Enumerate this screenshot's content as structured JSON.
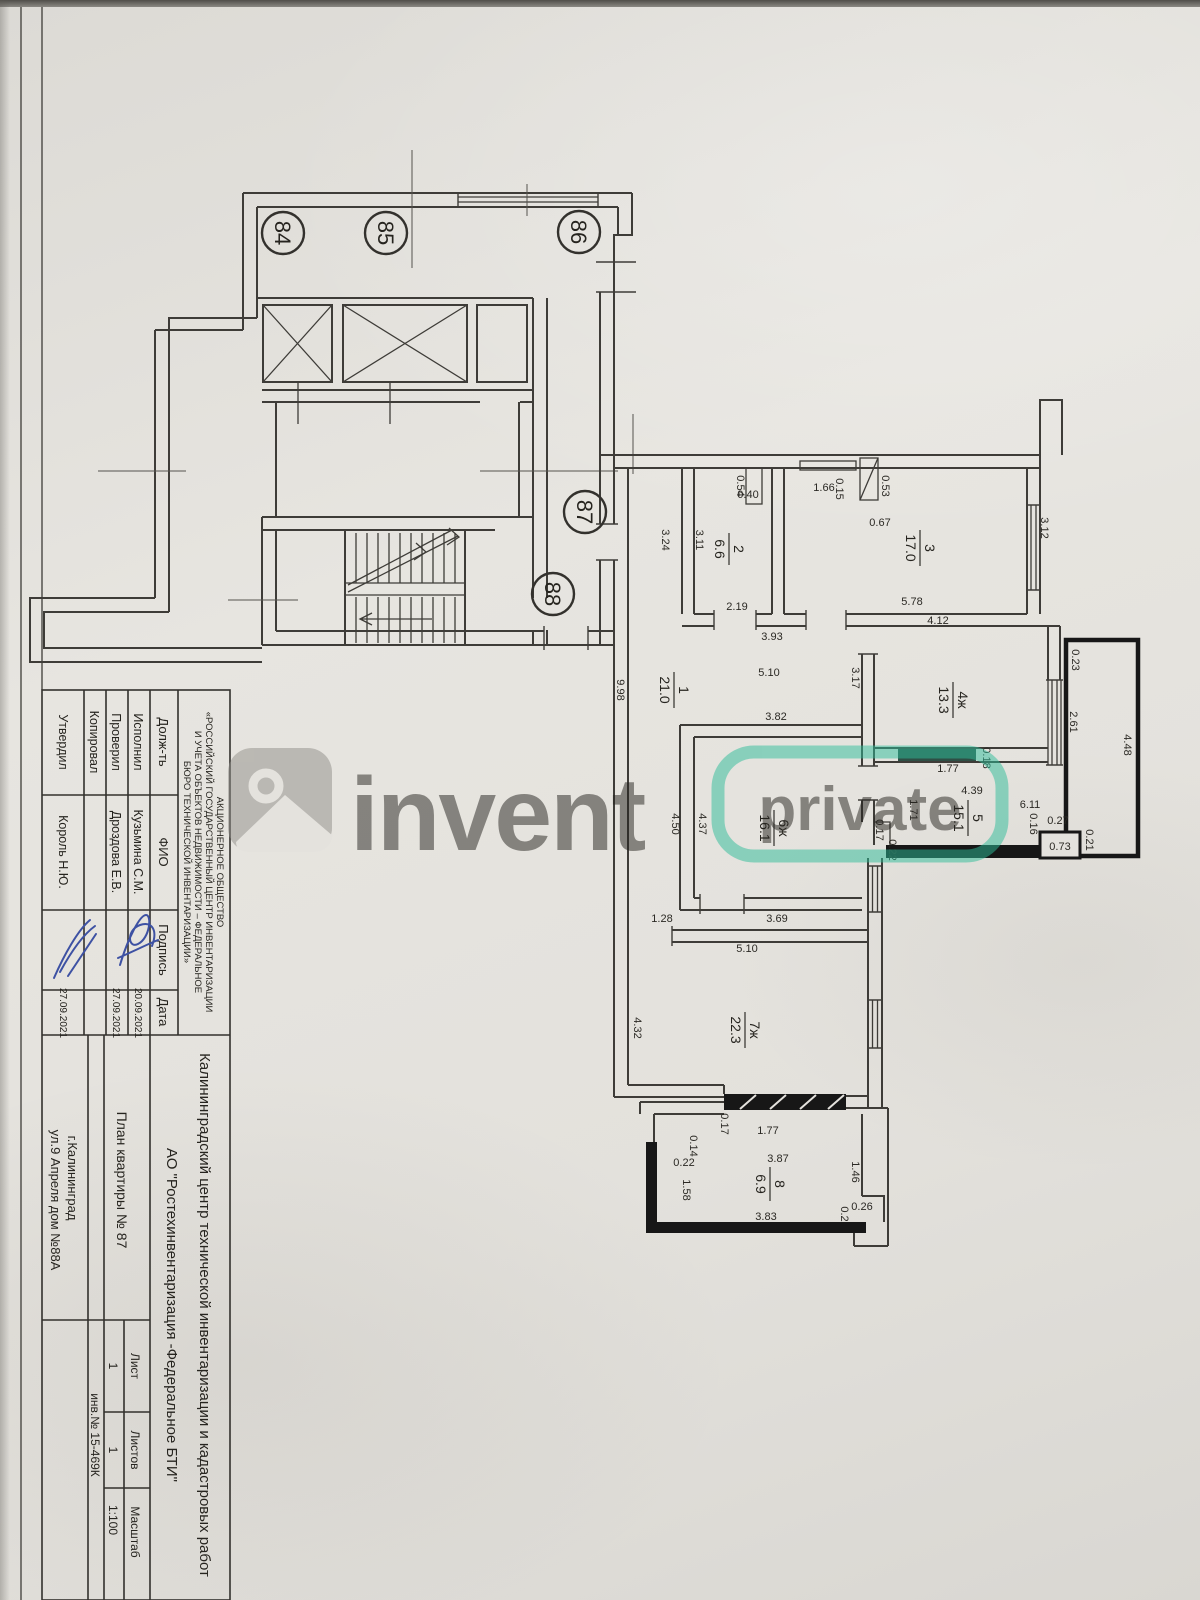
{
  "document": {
    "org_lines": [
      "АКЦИОНЕРНОЕ ОБЩЕСТВО",
      "«РОССИЙСКИЙ ГОСУДАРСТВЕННЫЙ ЦЕНТР ИНВЕНТАРИЗАЦИИ",
      "И УЧЕТА ОБЪЕКТОВ НЕДВИЖИМОСТИ – ФЕДЕРАЛЬНОЕ",
      "БЮРО ТЕХНИЧЕСКОЙ ИНВЕНТАРИЗАЦИИ»"
    ],
    "stamp": {
      "headers": {
        "role": "Долж-ть",
        "name": "ФИО",
        "signature": "Подпись",
        "date": "Дата"
      },
      "rows": [
        {
          "role": "Исполнил",
          "name": "Кузьмина С.М.",
          "date": "20.09.2021"
        },
        {
          "role": "Проверил",
          "name": "Дроздова Е.В.",
          "date": "27.09.2021"
        },
        {
          "role": "Копировал",
          "name": "",
          "date": ""
        },
        {
          "role": "Утвердил",
          "name": "Король Н.Ю.",
          "date": "27.09.2021"
        }
      ]
    },
    "title_center": "Калининградский центр технической инвентаризации и кадастровых работ",
    "title_company": "АО \"Ростехинвентаризация -Федеральное БТИ\"",
    "plan_title": "План квартиры № 87",
    "city": "г.Калининград",
    "address": "ул.9 Апреля дом №88А",
    "sheet": {
      "list_label": "Лист",
      "list_value": "1",
      "lists_label": "Листов",
      "lists_value": "1",
      "scale_label": "Масштаб",
      "scale_value": "1:100"
    },
    "inventory_number": "инв.№ 15-469К"
  },
  "watermark": {
    "brand": "invent",
    "badge": "private"
  },
  "plan": {
    "apartments": [
      "84",
      "85",
      "86",
      "87",
      "88"
    ],
    "rooms": [
      {
        "num": "1",
        "area": "21.0"
      },
      {
        "num": "2",
        "area": "6.6"
      },
      {
        "num": "3",
        "area": "17.0"
      },
      {
        "num": "4ж",
        "area": "13.3"
      },
      {
        "num": "5",
        "area": "15.1"
      },
      {
        "num": "6ж",
        "area": "16.1"
      },
      {
        "num": "7ж",
        "area": "22.3"
      },
      {
        "num": "8",
        "area": "6.9"
      }
    ],
    "dims": [
      "0.54",
      "0.40",
      "1.66",
      "0.15",
      "0.53",
      "0.67",
      "3.24",
      "3.11",
      "2.19",
      "3.93",
      "5.78",
      "3.12",
      "4.12",
      "9.98",
      "5.10",
      "3.82",
      "3.17",
      "0.23",
      "2.61",
      "4.48",
      "1.77",
      "0.18",
      "4.39",
      "6.11",
      "1.71",
      "0.17",
      "0.22",
      "0.16",
      "0.27",
      "0.73",
      "0.21",
      "4.50",
      "4.37",
      "3.69",
      "1.28",
      "5.10",
      "4.32",
      "0.17",
      "1.77",
      "0.14",
      "0.22",
      "1.58",
      "3.87",
      "3.83",
      "1.46",
      "0.26",
      "0.2"
    ]
  }
}
